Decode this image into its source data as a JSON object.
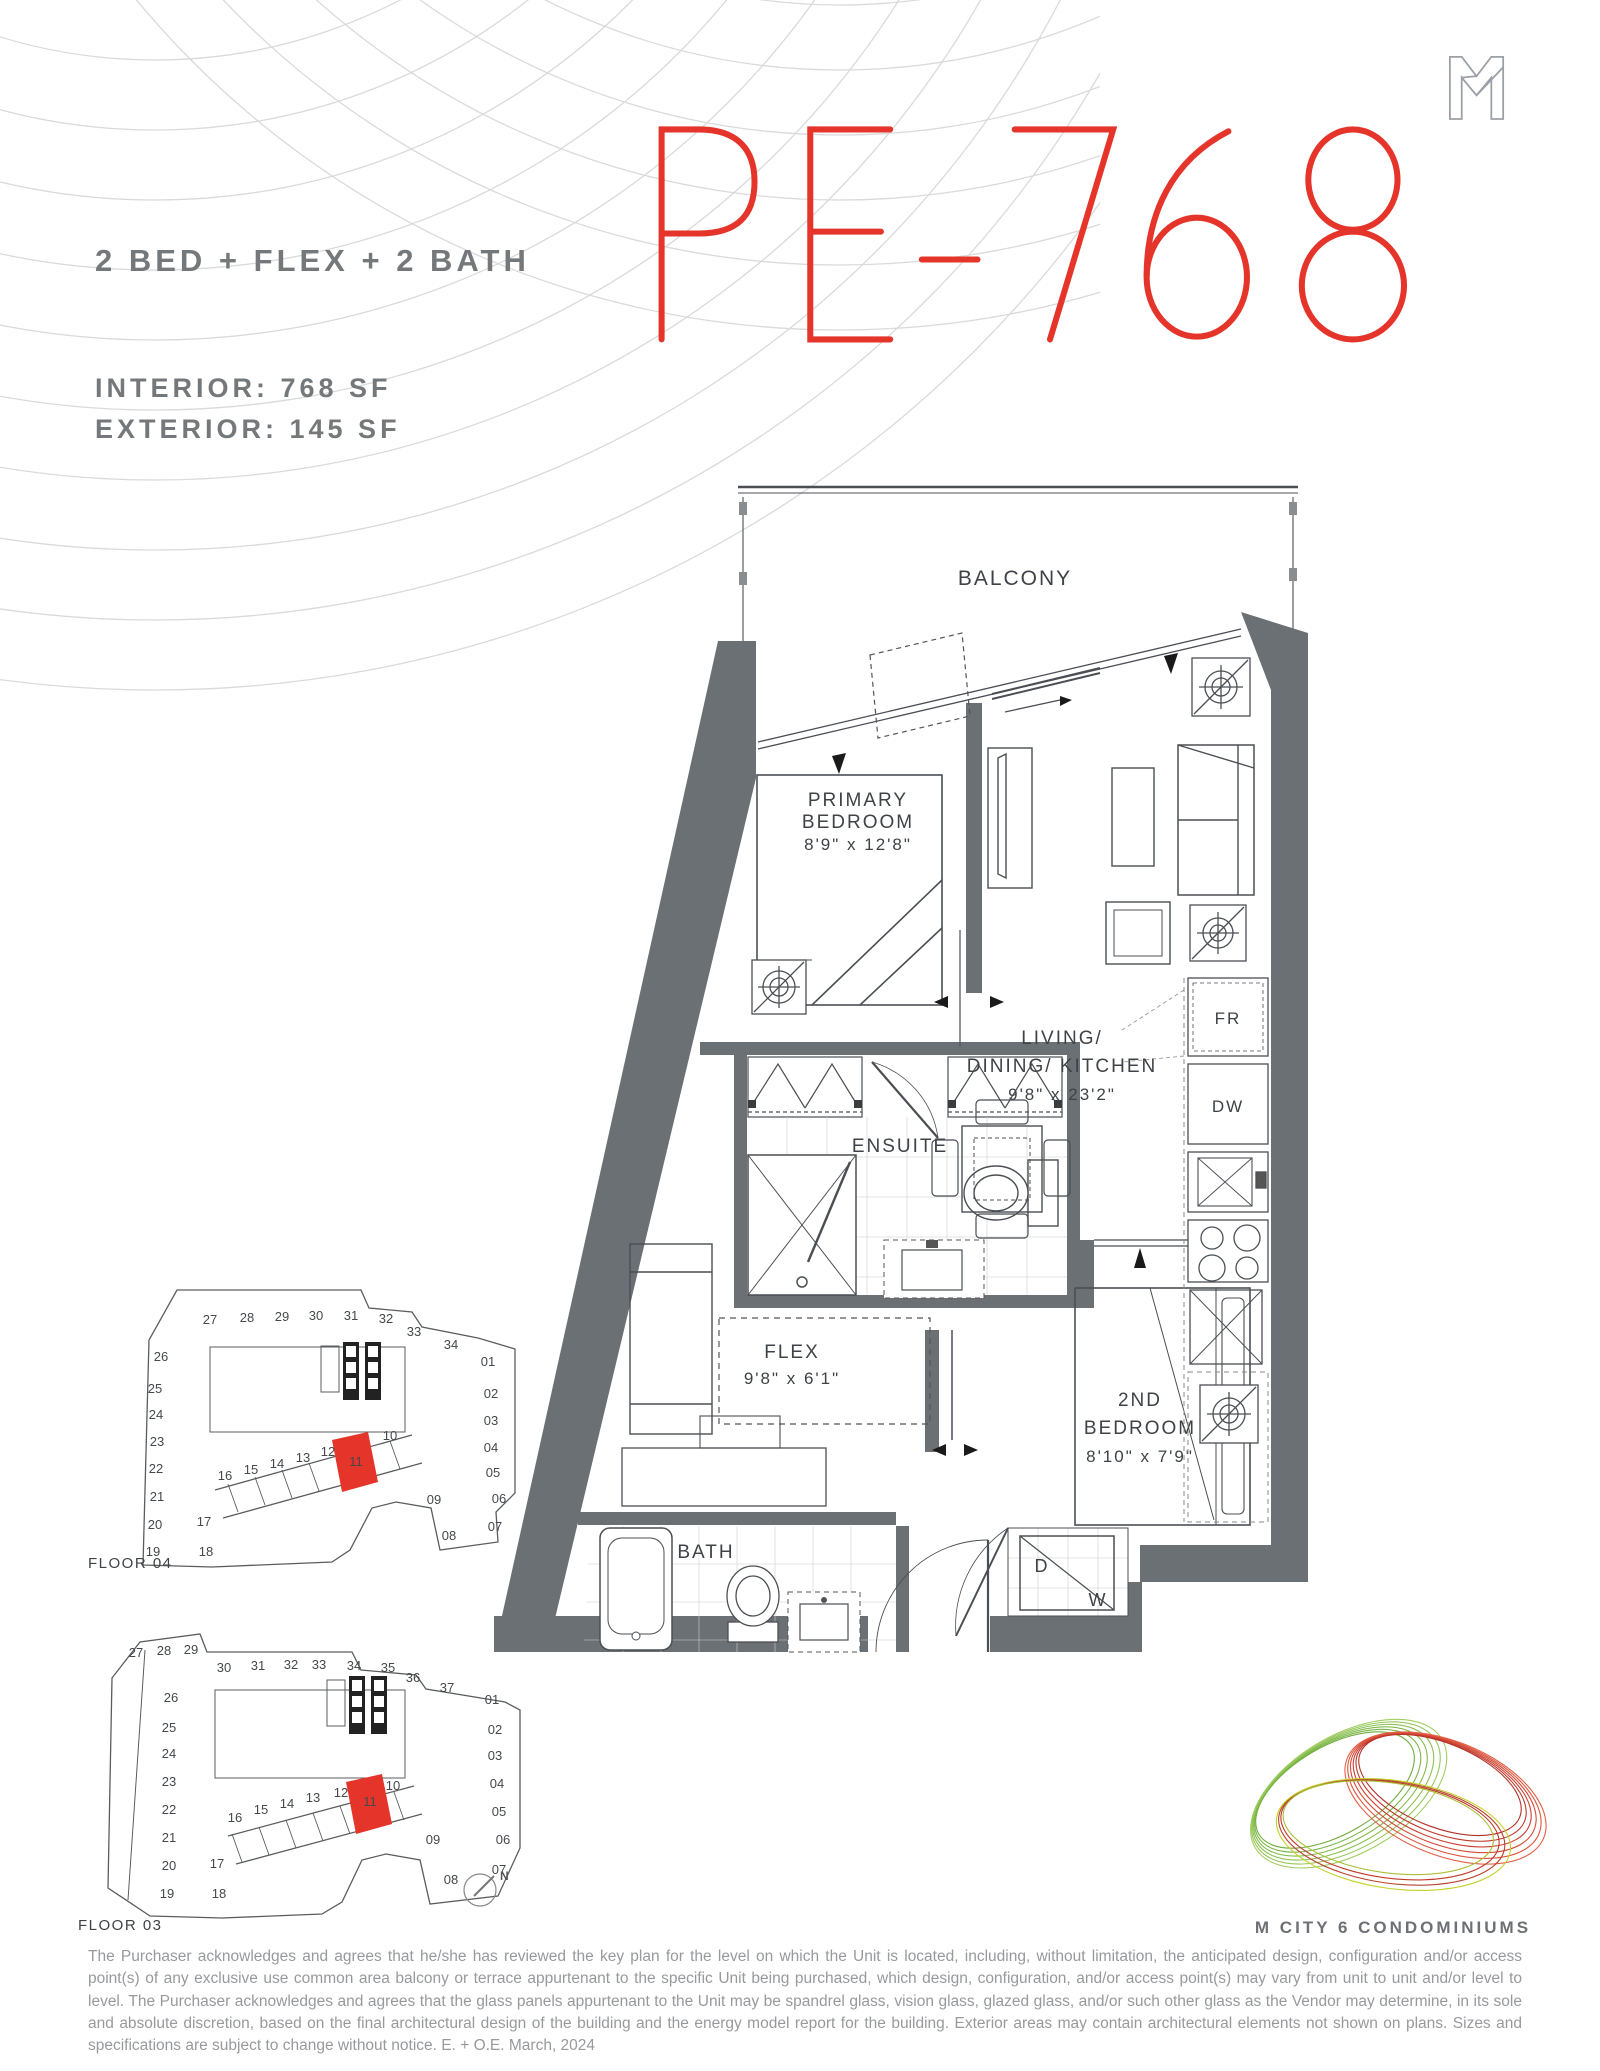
{
  "header": {
    "config": "2 BED + FLEX + 2 BATH",
    "interior": "INTERIOR:  768 SF",
    "exterior": "EXTERIOR:  145 SF",
    "unit_title": "PE-768"
  },
  "plan": {
    "balcony": "BALCONY",
    "primary": {
      "line1": "PRIMARY",
      "line2": "BEDROOM",
      "dims": "8'9\" x 12'8\""
    },
    "living": {
      "line1": "LIVING/",
      "line2": "DINING/ KITCHEN",
      "dims": "9'8\" x 23'2\""
    },
    "ensuite": "ENSUITE",
    "flex": {
      "name": "FLEX",
      "dims": "9'8\" x 6'1\""
    },
    "bath": "BATH",
    "second": {
      "line1": "2ND",
      "line2": "BEDROOM",
      "dims": "8'10\" x 7'9\""
    },
    "fridge": "FR",
    "dishwasher": "DW",
    "dryer": "D",
    "washer": "W"
  },
  "keyplans": {
    "floor04": {
      "label": "FLOOR 04",
      "units": [
        {
          "n": "27",
          "x": 150,
          "y": 74
        },
        {
          "n": "28",
          "x": 187,
          "y": 72
        },
        {
          "n": "29",
          "x": 222,
          "y": 71
        },
        {
          "n": "30",
          "x": 256,
          "y": 70
        },
        {
          "n": "31",
          "x": 291,
          "y": 70
        },
        {
          "n": "32",
          "x": 326,
          "y": 73
        },
        {
          "n": "33",
          "x": 354,
          "y": 86
        },
        {
          "n": "34",
          "x": 391,
          "y": 99
        },
        {
          "n": "01",
          "x": 428,
          "y": 116
        },
        {
          "n": "02",
          "x": 431,
          "y": 148
        },
        {
          "n": "03",
          "x": 431,
          "y": 175
        },
        {
          "n": "04",
          "x": 431,
          "y": 202
        },
        {
          "n": "05",
          "x": 433,
          "y": 227
        },
        {
          "n": "06",
          "x": 439,
          "y": 253
        },
        {
          "n": "07",
          "x": 435,
          "y": 281
        },
        {
          "n": "08",
          "x": 389,
          "y": 290
        },
        {
          "n": "09",
          "x": 374,
          "y": 254
        },
        {
          "n": "10",
          "x": 330,
          "y": 190
        },
        {
          "n": "11",
          "x": 296,
          "y": 216,
          "hl": true
        },
        {
          "n": "12",
          "x": 268,
          "y": 206
        },
        {
          "n": "13",
          "x": 243,
          "y": 212
        },
        {
          "n": "14",
          "x": 217,
          "y": 218
        },
        {
          "n": "15",
          "x": 191,
          "y": 224
        },
        {
          "n": "16",
          "x": 165,
          "y": 230
        },
        {
          "n": "17",
          "x": 144,
          "y": 276
        },
        {
          "n": "18",
          "x": 146,
          "y": 306
        },
        {
          "n": "19",
          "x": 93,
          "y": 306
        },
        {
          "n": "20",
          "x": 95,
          "y": 279
        },
        {
          "n": "21",
          "x": 97,
          "y": 251
        },
        {
          "n": "22",
          "x": 96,
          "y": 223
        },
        {
          "n": "23",
          "x": 97,
          "y": 196
        },
        {
          "n": "24",
          "x": 96,
          "y": 169
        },
        {
          "n": "25",
          "x": 95,
          "y": 143
        },
        {
          "n": "26",
          "x": 101,
          "y": 111
        }
      ]
    },
    "floor03": {
      "label": "FLOOR 03",
      "compass": "N",
      "units": [
        {
          "n": "27",
          "x": 86,
          "y": 67
        },
        {
          "n": "28",
          "x": 114,
          "y": 65
        },
        {
          "n": "29",
          "x": 141,
          "y": 64
        },
        {
          "n": "30",
          "x": 174,
          "y": 82
        },
        {
          "n": "31",
          "x": 208,
          "y": 80
        },
        {
          "n": "32",
          "x": 241,
          "y": 79
        },
        {
          "n": "33",
          "x": 269,
          "y": 79
        },
        {
          "n": "34",
          "x": 304,
          "y": 80
        },
        {
          "n": "35",
          "x": 338,
          "y": 82
        },
        {
          "n": "36",
          "x": 363,
          "y": 92
        },
        {
          "n": "37",
          "x": 397,
          "y": 102
        },
        {
          "n": "01",
          "x": 442,
          "y": 114
        },
        {
          "n": "02",
          "x": 445,
          "y": 144
        },
        {
          "n": "03",
          "x": 445,
          "y": 170
        },
        {
          "n": "04",
          "x": 447,
          "y": 198
        },
        {
          "n": "05",
          "x": 449,
          "y": 226
        },
        {
          "n": "06",
          "x": 453,
          "y": 254
        },
        {
          "n": "07",
          "x": 449,
          "y": 284
        },
        {
          "n": "08",
          "x": 401,
          "y": 294
        },
        {
          "n": "09",
          "x": 383,
          "y": 254
        },
        {
          "n": "10",
          "x": 343,
          "y": 200
        },
        {
          "n": "11",
          "x": 320,
          "y": 216,
          "hl": true
        },
        {
          "n": "12",
          "x": 291,
          "y": 207
        },
        {
          "n": "13",
          "x": 263,
          "y": 212
        },
        {
          "n": "14",
          "x": 237,
          "y": 218
        },
        {
          "n": "15",
          "x": 211,
          "y": 224
        },
        {
          "n": "16",
          "x": 185,
          "y": 232
        },
        {
          "n": "17",
          "x": 167,
          "y": 278
        },
        {
          "n": "18",
          "x": 169,
          "y": 308
        },
        {
          "n": "19",
          "x": 117,
          "y": 308
        },
        {
          "n": "20",
          "x": 119,
          "y": 280
        },
        {
          "n": "21",
          "x": 119,
          "y": 252
        },
        {
          "n": "22",
          "x": 119,
          "y": 224
        },
        {
          "n": "23",
          "x": 119,
          "y": 196
        },
        {
          "n": "24",
          "x": 119,
          "y": 168
        },
        {
          "n": "25",
          "x": 119,
          "y": 142
        },
        {
          "n": "26",
          "x": 121,
          "y": 112
        }
      ]
    }
  },
  "footer": {
    "brand": "M CITY 6 CONDOMINIUMS",
    "disclaimer": "The Purchaser acknowledges and agrees that he/she has reviewed the key plan for the level on which the Unit is located, including, without limitation, the anticipated design, configuration and/or access point(s) of any exclusive use common area balcony or terrace appurtenant to the specific Unit being purchased, which design, configuration, and/or access point(s) may vary from unit to unit and/or level to level. The Purchaser acknowledges and agrees that the glass panels appurtenant to the Unit may be spandrel glass, vision glass, glazed glass, and/or such other glass as the Vendor may determine, in its sole and absolute discretion, based on the final architectural design of the building and the energy model report for the building. Exterior areas may contain architectural elements not shown on plans. Sizes and specifications are subject to change without notice. E. + O.E. March, 2024"
  },
  "colors": {
    "accent_red": "#e5352b",
    "wall_gray": "#6b7075",
    "text_gray": "#75787b"
  }
}
